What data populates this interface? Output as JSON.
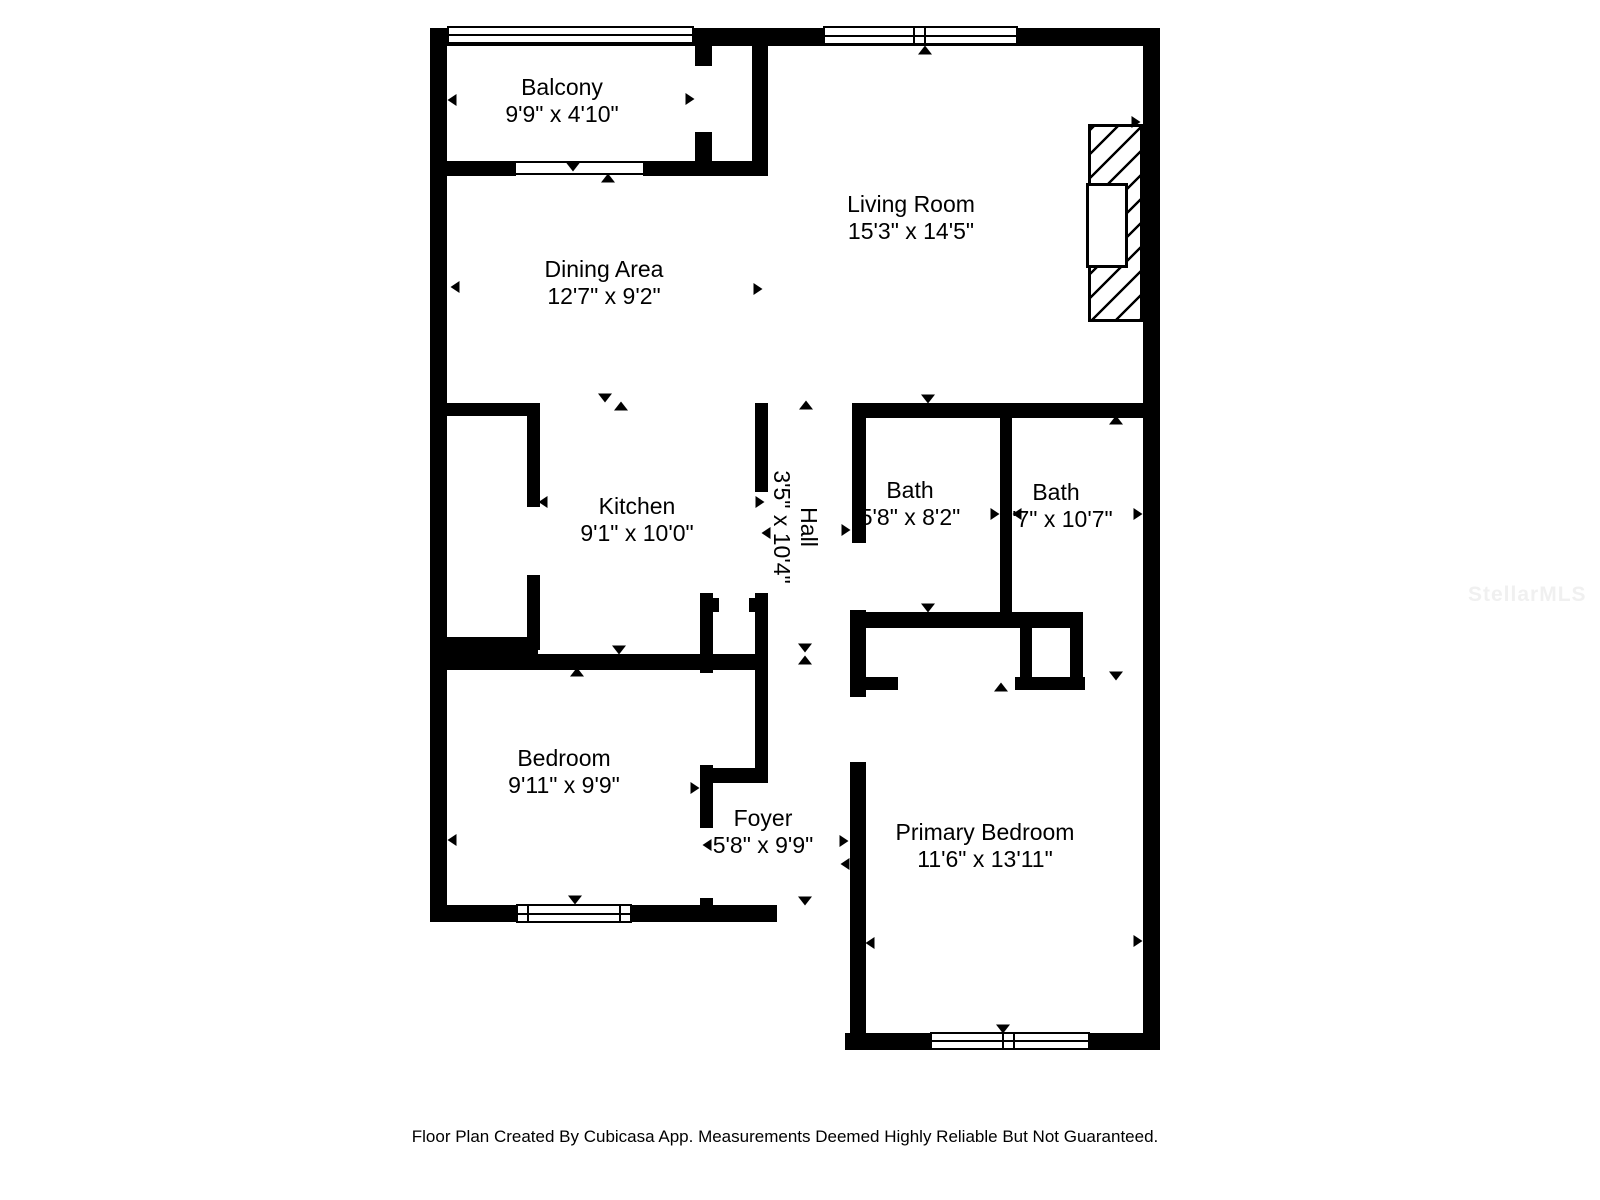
{
  "floor_plan": {
    "rooms": [
      {
        "name": "Balcony",
        "dims": "9'9\" x 4'10\""
      },
      {
        "name": "Living Room",
        "dims": "15'3\" x 14'5\""
      },
      {
        "name": "Dining Area",
        "dims": "12'7\" x 9'2\""
      },
      {
        "name": "Kitchen",
        "dims": "9'1\" x 10'0\""
      },
      {
        "name": "Hall",
        "dims": "3'5\" x 10'4\"",
        "orientation": "vertical"
      },
      {
        "name": "Bath",
        "dims": "5'8\" x 8'2\""
      },
      {
        "name": "Bath",
        "dims": "5'7\" x 10'7\""
      },
      {
        "name": "Bedroom",
        "dims": "9'11\" x 9'9\""
      },
      {
        "name": "Foyer",
        "dims": "5'8\" x 9'9\""
      },
      {
        "name": "Primary Bedroom",
        "dims": "11'6\" x 13'11\""
      }
    ],
    "footer": "Floor Plan Created By Cubicasa App. Measurements Deemed Highly Reliable But Not Guaranteed.",
    "watermark": "StellarMLS",
    "colors": {
      "walls": "#000000",
      "background": "#ffffff",
      "text": "#000000",
      "watermark": "#f0f0f0"
    }
  }
}
